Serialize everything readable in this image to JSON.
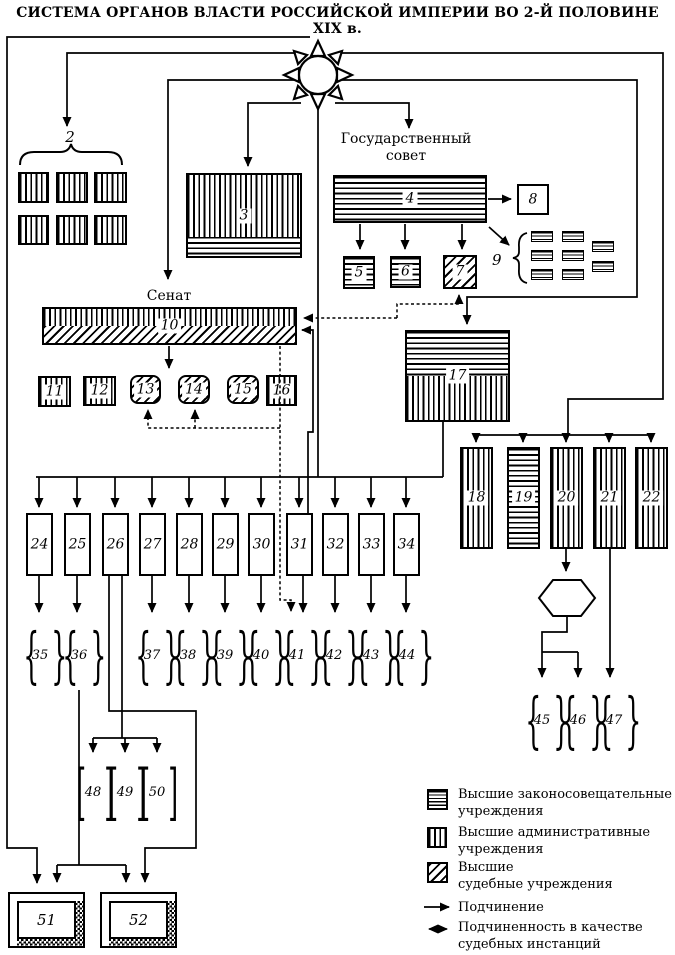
{
  "title": "СИСТЕМА ОРГАНОВ ВЛАСТИ РОССИЙСКОЙ ИМПЕРИИ ВО 2-Й ПОЛОВИНЕ XIX в.",
  "labels": {
    "state_council_l1": "Государственный",
    "state_council_l2": "совет",
    "senate": "Сенат"
  },
  "glyphs": {
    "brace_l": "{",
    "brace_r": "}",
    "bracket_l": "[",
    "bracket_r": "]"
  },
  "nodes": {
    "n1": "1",
    "n2": "2",
    "n3": "3",
    "n4": "4",
    "n5": "5",
    "n6": "6",
    "n7": "7",
    "n8": "8",
    "n9": "9",
    "n10": "10",
    "n11": "11",
    "n12": "12",
    "n13": "13",
    "n14": "14",
    "n15": "15",
    "n16": "16",
    "n17": "17",
    "n18": "18",
    "n19": "19",
    "n20": "20",
    "n21": "21",
    "n22": "22",
    "n23": "23",
    "n24": "24",
    "n25": "25",
    "n26": "26",
    "n27": "27",
    "n28": "28",
    "n29": "29",
    "n30": "30",
    "n31": "31",
    "n32": "32",
    "n33": "33",
    "n34": "34",
    "n35": "35",
    "n36": "36",
    "n37": "37",
    "n38": "38",
    "n39": "39",
    "n40": "40",
    "n41": "41",
    "n42": "42",
    "n43": "43",
    "n44": "44",
    "n45": "45",
    "n46": "46",
    "n47": "47",
    "n48": "48",
    "n49": "49",
    "n50": "50",
    "n51": "51",
    "n52": "52"
  },
  "legend": {
    "items": [
      {
        "swatch": "horizontal-hatch",
        "l1": "Высшие законосовещательные",
        "l2": "учреждения"
      },
      {
        "swatch": "vertical-hatch",
        "l1": "Высшие административные",
        "l2": "учреждения"
      },
      {
        "swatch": "diagonal-hatch",
        "l1": "Высшие",
        "l2": "судебные учреждения"
      },
      {
        "swatch": "solid-arrow",
        "l1": "Подчинение",
        "l2": ""
      },
      {
        "swatch": "double-dashed-arrow",
        "l1": "Подчиненность в качестве",
        "l2": "судебных инстанций"
      }
    ]
  }
}
